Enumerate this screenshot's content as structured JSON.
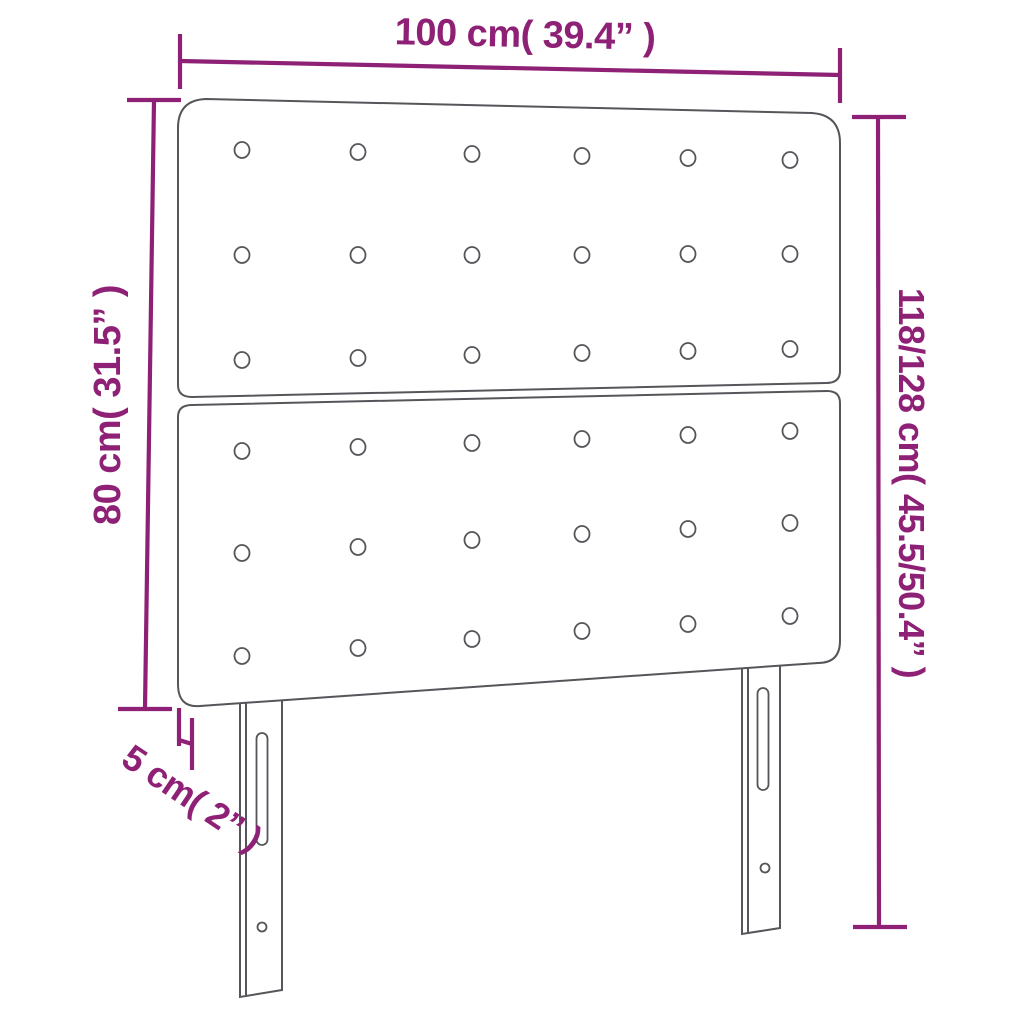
{
  "title": "Headboard dimension diagram",
  "colors": {
    "accent": "#8e2176",
    "outline": "#55565a",
    "background": "#ffffff"
  },
  "dimensions": {
    "width": {
      "label": "100 cm( 39.4” )",
      "cm": "100",
      "inch": "39.4"
    },
    "panel_height": {
      "label": "80 cm( 31.5” )",
      "cm": "80",
      "inch": "31.5"
    },
    "total_height": {
      "label": "118/128 cm( 45.5/50.4” )",
      "cm": "118/128",
      "inch": "45.5/50.4"
    },
    "depth": {
      "label": "5 cm( 2” )",
      "cm": "5",
      "inch": "2"
    }
  },
  "diagram": {
    "object": "tufted headboard, two stacked panels on two slotted legs",
    "panels": 2,
    "button_rows_per_panel": 3,
    "button_columns": 6,
    "legs": 2,
    "leg_features": [
      "adjustment-slot",
      "screw-hole"
    ]
  }
}
